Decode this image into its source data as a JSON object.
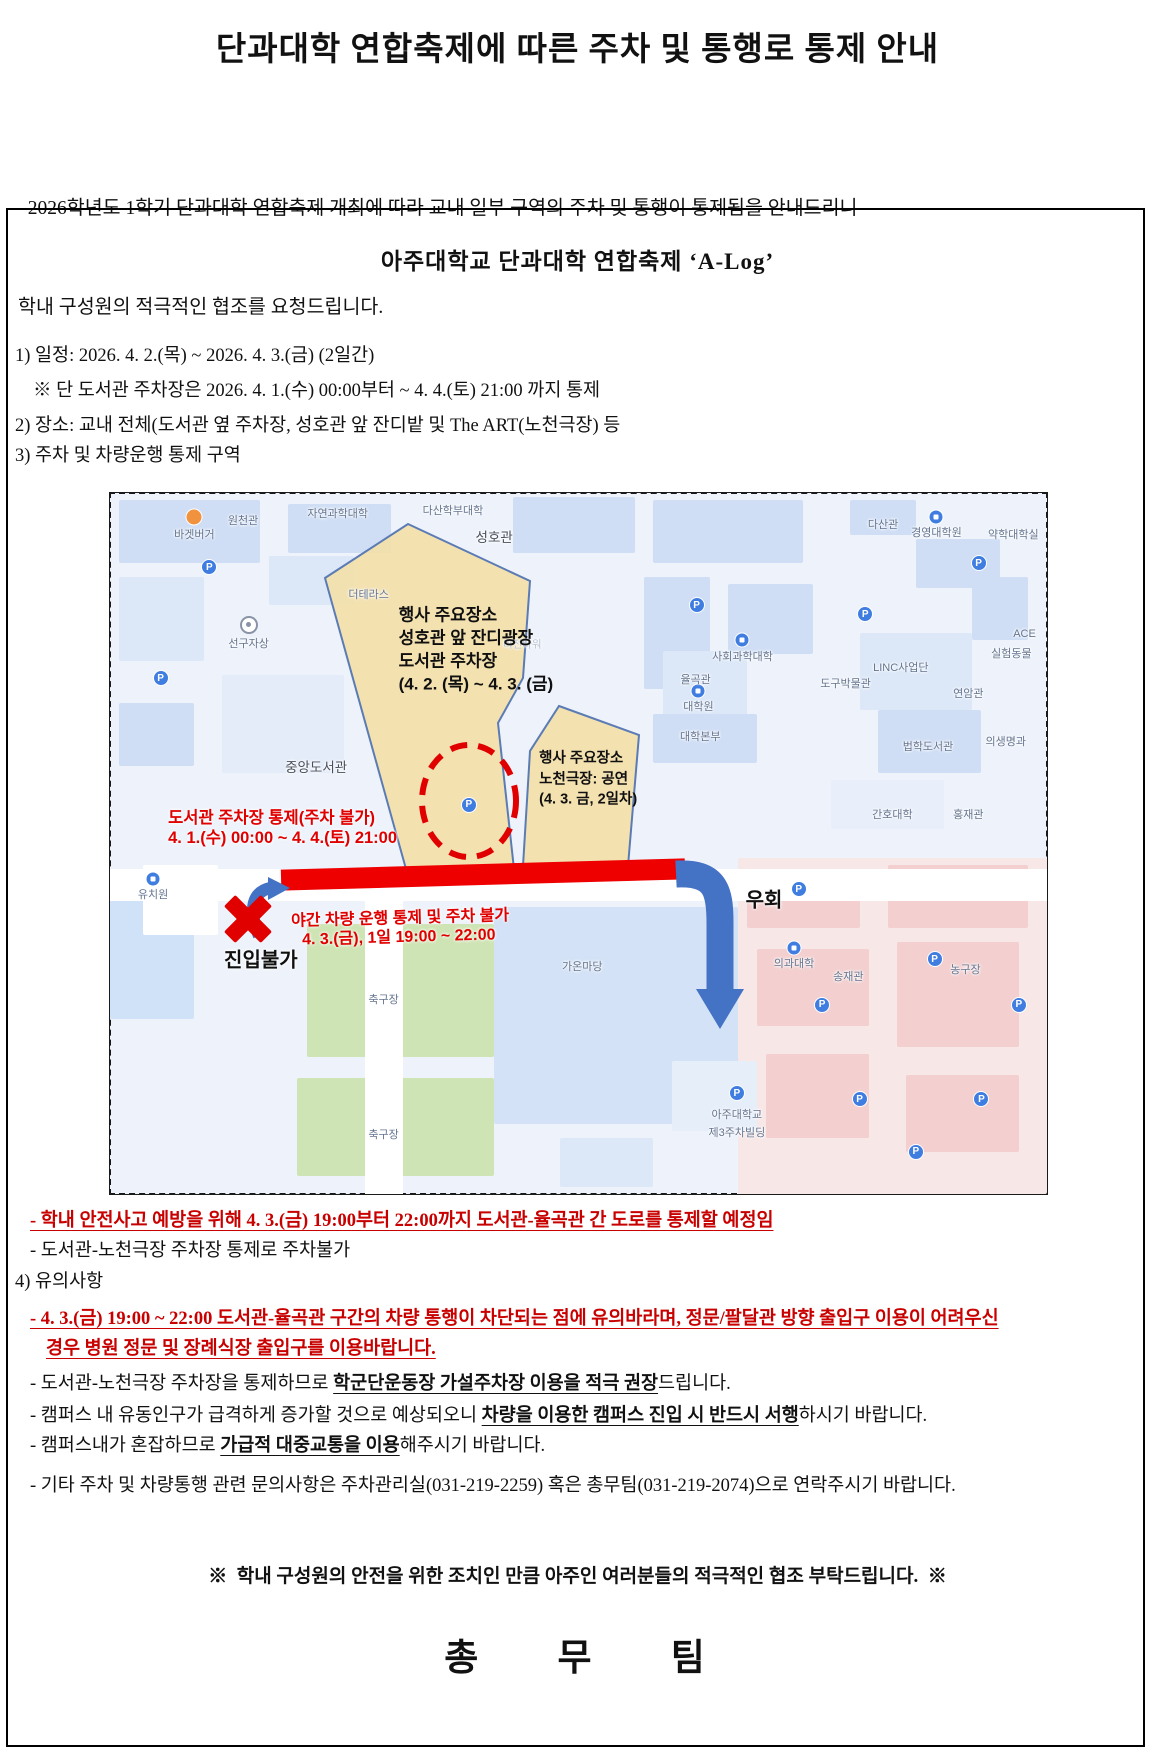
{
  "title": "단과대학 연합축제에 따른 주차 및 통행로 통제 안내",
  "intro": {
    "line1": "  2026학년도 1학기 단과대학 연합축제 개최에 따라 교내 일부 구역의 주차 및 통행이 통제됨을 안내드리니",
    "line2": "학내 구성원의 적극적인 협조를 요청드립니다."
  },
  "box_title": "아주대학교 단과대학 연합축제 ‘A-Log’",
  "colors": {
    "accent_red": "#c80000",
    "map_red": "#e00000",
    "arrow_blue": "#4472c4",
    "event_yellow": "#f3e0a9"
  },
  "lines": [
    {
      "y": 357,
      "x": 15,
      "segs": [
        {
          "t": "1) 일정: 2026. 4. 2.(목) ~ 2026. 4. 3.(금) (2일간)"
        }
      ]
    },
    {
      "y": 392,
      "x": 33,
      "segs": [
        {
          "t": "※ 단 도서관 주차장은 2026. 4. 1.(수) 00:00부터 ~ 4. 4.(토) 21:00 까지 통제"
        }
      ]
    },
    {
      "y": 427,
      "x": 15,
      "segs": [
        {
          "t": "2) 장소: 교내 전체(도서관 옆 주차장, 성호관 앞 잔디밭 및 The ART(노천극장) 등"
        }
      ]
    },
    {
      "y": 457,
      "x": 15,
      "segs": [
        {
          "t": "3) 주차 및 차량운행 통제 구역"
        }
      ]
    },
    {
      "y": 1222,
      "x": 30,
      "segs": [
        {
          "t": "- 학내 안전사고 예방을 위해 4. 3.(금) 19:00부터 22:00까지 도서관-율곡관 간 도로를 통제할 예정임",
          "cls": "red"
        }
      ]
    },
    {
      "y": 1252,
      "x": 30,
      "segs": [
        {
          "t": "- 도서관-노천극장 주차장 통제로 주차불가"
        }
      ]
    },
    {
      "y": 1283,
      "x": 15,
      "segs": [
        {
          "t": "4) 유의사항"
        }
      ]
    },
    {
      "y": 1320,
      "x": 30,
      "segs": [
        {
          "t": "- 4. 3.(금) 19:00 ~ 22:00 도서관-율곡관 구간의 차량 통행이 차단되는 점에 유의바라며, 정문/팔달관 방향 출입구 이용이 어려우신",
          "cls": "red"
        }
      ]
    },
    {
      "y": 1350,
      "x": 46,
      "segs": [
        {
          "t": "경우 병원 정문 및 장례식장 출입구를 이용바랍니다.",
          "cls": "red"
        }
      ]
    },
    {
      "y": 1385,
      "x": 30,
      "segs": [
        {
          "t": "- 도서관-노천극장 주차장을 통제하므로 "
        },
        {
          "t": "학군단운동장 가설주차장 이용을 적극 권장",
          "cls": "u"
        },
        {
          "t": "드립니다."
        }
      ]
    },
    {
      "y": 1417,
      "x": 30,
      "segs": [
        {
          "t": "- 캠퍼스 내 유동인구가 급격하게 증가할 것으로 예상되오니 "
        },
        {
          "t": "차량을 이용한 캠퍼스 진입 시 반드시 서행",
          "cls": "u"
        },
        {
          "t": "하시기 바랍니다."
        }
      ]
    },
    {
      "y": 1447,
      "x": 30,
      "segs": [
        {
          "t": "- 캠퍼스내가 혼잡하므로 "
        },
        {
          "t": "가급적 대중교통을 이용",
          "cls": "u"
        },
        {
          "t": "해주시기 바랍니다."
        }
      ]
    },
    {
      "y": 1487,
      "x": 30,
      "segs": [
        {
          "t": "- 기타 주차 및 차량통행 관련 문의사항은 주차관리실(031-219-2259) 혹은 총무팀(031-219-2074)으로 연락주시기 바랍니다."
        }
      ]
    },
    {
      "y": 1578,
      "center": true,
      "cls": "notice",
      "segs": [
        {
          "t": "※  학내 구성원의 안전을 위한 조치인 만큼 아주인 여러분들의 적극적인 협조 부탁드립니다.  ※"
        }
      ]
    },
    {
      "y": 1660,
      "center": true,
      "cls": "team",
      "segs": [
        {
          "t": "총 무 팀"
        }
      ]
    }
  ],
  "map": {
    "labels": [
      {
        "t": "원천관",
        "x": 14.2,
        "y": 3.9
      },
      {
        "t": "바겟버거",
        "x": 9.0,
        "y": 5.8
      },
      {
        "t": "자연과학대학",
        "x": 24.3,
        "y": 2.9
      },
      {
        "t": "다산학부대학",
        "x": 36.6,
        "y": 2.4
      },
      {
        "t": "성호관",
        "x": 41.0,
        "y": 6.1,
        "cls": "lg"
      },
      {
        "t": "다산관",
        "x": 82.5,
        "y": 4.4
      },
      {
        "t": "경영대학원",
        "x": 88.2,
        "y": 5.6
      },
      {
        "t": "약학대학실",
        "x": 96.4,
        "y": 5.9
      },
      {
        "t": "더테라스",
        "x": 27.6,
        "y": 14.4
      },
      {
        "t": "선구자상",
        "x": 14.8,
        "y": 21.4
      },
      {
        "t": "사회과학대학",
        "x": 67.5,
        "y": 23.3
      },
      {
        "t": "율곡관",
        "x": 62.5,
        "y": 26.6
      },
      {
        "t": "대학원",
        "x": 62.8,
        "y": 30.4
      },
      {
        "t": "대학본부",
        "x": 63.0,
        "y": 34.7
      },
      {
        "t": "ACE",
        "x": 97.6,
        "y": 20.1
      },
      {
        "t": "실험동물",
        "x": 96.2,
        "y": 22.8
      },
      {
        "t": "LINC사업단",
        "x": 84.4,
        "y": 24.8
      },
      {
        "t": "도구박물관",
        "x": 78.5,
        "y": 27.1
      },
      {
        "t": "연암관",
        "x": 91.6,
        "y": 28.5
      },
      {
        "t": "법학도서관",
        "x": 87.3,
        "y": 36.1
      },
      {
        "t": "의생명과",
        "x": 95.6,
        "y": 35.4
      },
      {
        "t": "간호대학",
        "x": 83.5,
        "y": 45.8
      },
      {
        "t": "홍재관",
        "x": 91.6,
        "y": 45.8
      },
      {
        "t": "중앙도서관",
        "x": 22.0,
        "y": 38.9,
        "cls": "lg"
      },
      {
        "t": "비전타워",
        "x": 44.0,
        "y": 21.5,
        "cls": "faint"
      },
      {
        "t": "유치원",
        "x": 4.6,
        "y": 57.2
      },
      {
        "t": "가온마당",
        "x": 50.4,
        "y": 67.5
      },
      {
        "t": "의과대학",
        "x": 73.0,
        "y": 67.0
      },
      {
        "t": "송재관",
        "x": 78.8,
        "y": 68.9
      },
      {
        "t": "농구장",
        "x": 91.3,
        "y": 67.9
      },
      {
        "t": "축구장",
        "x": 29.2,
        "y": 72.2
      },
      {
        "t": "축구장",
        "x": 29.2,
        "y": 91.5
      },
      {
        "t": "아주대학교",
        "x": 66.9,
        "y": 88.6
      },
      {
        "t": "제3주차빌딩",
        "x": 66.9,
        "y": 91.1
      },
      {
        "t": "행사 주요장소",
        "x": 30.8,
        "y": 17.1,
        "cls": "pt1"
      },
      {
        "t": "성호관 앞 잔디광장",
        "x": 30.8,
        "y": 20.4,
        "cls": "pt1"
      },
      {
        "t": "도서관 주차장",
        "x": 30.8,
        "y": 23.7,
        "cls": "pt1"
      },
      {
        "t": "(4. 2. (목) ~ 4. 3. (금)",
        "x": 30.8,
        "y": 26.9,
        "cls": "pt1"
      },
      {
        "t": "행사 주요장소",
        "x": 45.8,
        "y": 37.7,
        "cls": "pt2"
      },
      {
        "t": "노천극장: 공연",
        "x": 45.8,
        "y": 40.6,
        "cls": "pt2"
      },
      {
        "t": "(4. 3. 금, 2일차)",
        "x": 45.8,
        "y": 43.5,
        "cls": "pt2"
      },
      {
        "t": "도서관 주차장 통제(주차 불가)",
        "x": 6.2,
        "y": 46.1,
        "cls": "rnote"
      },
      {
        "t": "4. 1.(수) 00:00 ~ 4. 4.(토) 21:00",
        "x": 6.2,
        "y": 48.9,
        "cls": "rnote"
      },
      {
        "t": "야간 차량 운행 통제 및 주차 불가",
        "x": 19.3,
        "y": 60.3,
        "cls": "rnote2"
      },
      {
        "t": "4. 3.(금), 1일 19:00 ~ 22:00",
        "x": 20.5,
        "y": 63.1,
        "cls": "rnote2"
      },
      {
        "t": "진입불가",
        "x": 16.1,
        "y": 66.3,
        "cls": "blk"
      },
      {
        "t": "우회",
        "x": 69.8,
        "y": 57.8,
        "cls": "blk"
      }
    ],
    "p_icons": [
      {
        "x": 10.6,
        "y": 10.6
      },
      {
        "x": 5.4,
        "y": 26.4
      },
      {
        "x": 62.6,
        "y": 16.0
      },
      {
        "x": 80.6,
        "y": 17.3
      },
      {
        "x": 92.7,
        "y": 10.0
      },
      {
        "x": 38.3,
        "y": 44.5
      },
      {
        "x": 66.9,
        "y": 85.6
      },
      {
        "x": 76.0,
        "y": 73.0
      },
      {
        "x": 88.0,
        "y": 66.5
      },
      {
        "x": 97.0,
        "y": 73.0
      },
      {
        "x": 80.0,
        "y": 86.5
      },
      {
        "x": 93.0,
        "y": 86.5
      },
      {
        "x": 86.0,
        "y": 94.0
      },
      {
        "x": 73.5,
        "y": 56.5
      }
    ],
    "building_icons": [
      {
        "k": "o",
        "x": 9.0,
        "y": 3.4,
        "name": "burger-shop-icon"
      },
      {
        "k": "b",
        "x": 88.2,
        "y": 3.4,
        "name": "building-icon"
      },
      {
        "k": "b",
        "x": 67.5,
        "y": 21.0,
        "name": "building-icon"
      },
      {
        "k": "b",
        "x": 62.8,
        "y": 28.2,
        "name": "building-icon"
      },
      {
        "k": "b",
        "x": 73.0,
        "y": 64.9,
        "name": "building-icon"
      },
      {
        "k": "b",
        "x": 4.6,
        "y": 55.0,
        "name": "building-icon"
      },
      {
        "k": "t",
        "x": 14.8,
        "y": 18.8,
        "name": "monument-icon"
      }
    ]
  }
}
